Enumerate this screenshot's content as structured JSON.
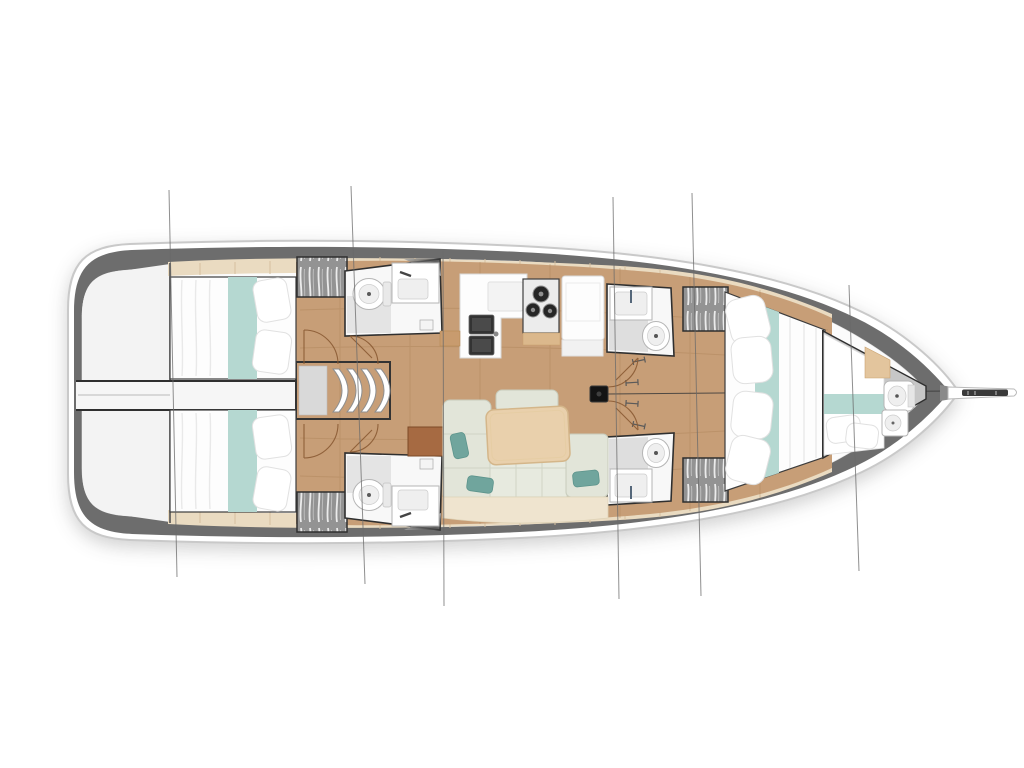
{
  "diagram": {
    "type": "yacht-interior-floor-plan",
    "subject": "sailing monohull layout, top-down view",
    "orientation": {
      "bow": "right",
      "stern": "left"
    },
    "areas": [
      {
        "id": "swim-platform",
        "label": "stern swim platform"
      },
      {
        "id": "aft-cabin-port",
        "label": "aft double cabin (top)"
      },
      {
        "id": "aft-cabin-starboard",
        "label": "aft double cabin (bottom)"
      },
      {
        "id": "companionway",
        "label": "companionway steps and corridor"
      },
      {
        "id": "head-aft-port",
        "label": "aft bathroom with toilet and sink (top)"
      },
      {
        "id": "head-aft-starboard",
        "label": "aft bathroom with toilet and sink (bottom)"
      },
      {
        "id": "galley",
        "label": "galley with double sink, 3-burner stove, fridge"
      },
      {
        "id": "salon",
        "label": "salon with L-sofa, table and cushions"
      },
      {
        "id": "chart-table",
        "label": "brown chart table"
      },
      {
        "id": "mast",
        "label": "mast foot on centerline"
      },
      {
        "id": "head-mid-port",
        "label": "mid bathroom with sink and toilet (top)"
      },
      {
        "id": "head-mid-starboard",
        "label": "mid bathroom with sink and toilet (bottom)"
      },
      {
        "id": "wardrobes",
        "label": "four hatched hanging lockers"
      },
      {
        "id": "owner-cabin",
        "label": "forward owner cabin with large berth"
      },
      {
        "id": "forepeak",
        "label": "forepeak crew cabin with berth, toilet and sink"
      },
      {
        "id": "bowsprit",
        "label": "bowsprit with anchor roller"
      },
      {
        "id": "rigging-section-lines",
        "label": "six thin vertical section/stay lines crossing the hull"
      }
    ],
    "counts": {
      "double_berths": 4,
      "heads": 5,
      "toilets": 5,
      "sinks": 7,
      "stove_burners": 3
    }
  },
  "colors": {
    "bg": "#ffffff",
    "hullWhite": "#ffffff",
    "hullStroke": "#c9c9c9",
    "deckBand": "#6d6d6d",
    "interior": "#fbfbfb",
    "cream": "#eadbc1",
    "creamTick": "#d5bf9e",
    "wood": "#c79e77",
    "woodLine": "#a87f54",
    "wallDark": "#2f2f2f",
    "roomWhite": "#f8f8f8",
    "fixtureFill": "#ffffff",
    "fixtureStroke": "#b5b5b5",
    "basinDark": "#333333",
    "aqua": "#b5d8d1",
    "linen": "#fdfdfd",
    "wardrobeGray": "#939393",
    "sofa": "#e2e5d9",
    "sofaBase": "#efe4cf",
    "cushionTeal": "#70a59d",
    "tableWood": "#e9d0ac",
    "brownDesk": "#a66a42",
    "mastBlack": "#141414",
    "arcBrown": "#8a5a33",
    "rigLine": "#6a6a6a",
    "forepeakFloor": "#c7c7c7"
  }
}
